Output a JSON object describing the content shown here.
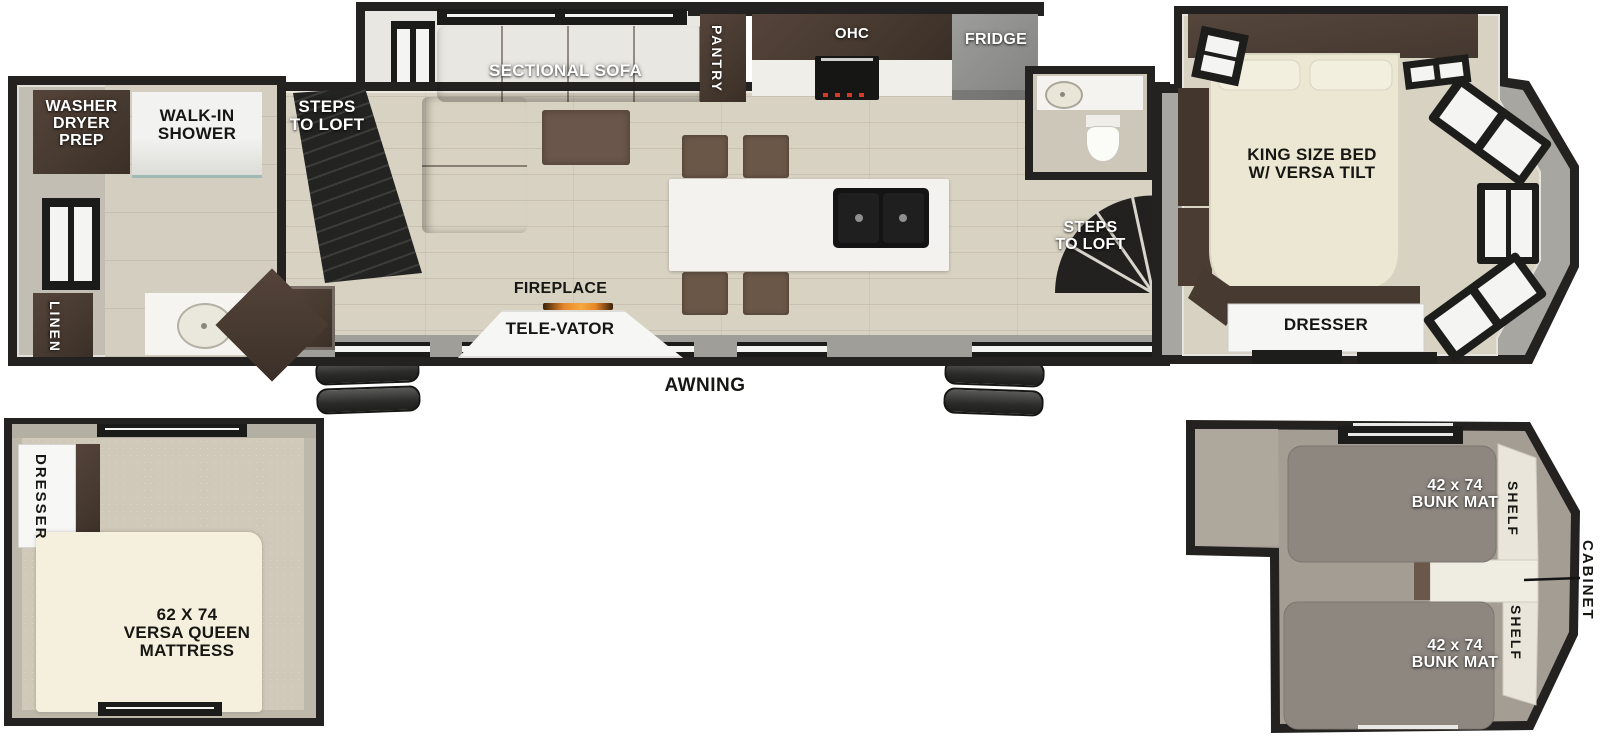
{
  "floorplan": {
    "rear_bath": {
      "washer_dryer_prep": "WASHER\nDRYER\nPREP",
      "walk_in_shower": "WALK-IN\nSHOWER",
      "linen": "LINEN"
    },
    "living": {
      "steps_to_loft": "STEPS\nTO LOFT",
      "sectional_sofa": "SECTIONAL SOFA",
      "fireplace": "FIREPLACE",
      "tele_vator": "TELE-VATOR"
    },
    "kitchen": {
      "pantry": "PANTRY",
      "ohc": "OHC",
      "fridge": "FRIDGE"
    },
    "bedroom": {
      "steps_to_loft": "STEPS\nTO LOFT",
      "king_bed": "KING SIZE BED\nW/ VERSA TILT",
      "dresser": "DRESSER"
    },
    "exterior": {
      "awning": "AWNING"
    },
    "queen_loft": {
      "dresser": "DRESSER",
      "mattress": "62 X 74\nVERSA QUEEN\nMATTRESS"
    },
    "bunk_loft": {
      "bunk_mat_top": "42 x 74\nBUNK MAT",
      "bunk_mat_bottom": "42 x 74\nBUNK MAT",
      "shelf_top": "SHELF",
      "shelf_bottom": "SHELF",
      "cabinet": "CABINET"
    }
  },
  "colors": {
    "wall_black": "#232220",
    "exterior_gray": "#a7a6a1",
    "floor_tan": "#d8d2c2",
    "sofa_brown": "#6f5a49",
    "cabinet_dark_brown": "#473a30",
    "counter_white": "#f3f2ee",
    "fridge_gray": "#909090",
    "bed_cream": "#ece7d2",
    "queen_loft_carpet": "#d0c9b9",
    "bunk_loft_carpet": "#a49d93",
    "bunk_mat_gray": "#8e8780",
    "fireplace_flame": "#e8862a"
  }
}
